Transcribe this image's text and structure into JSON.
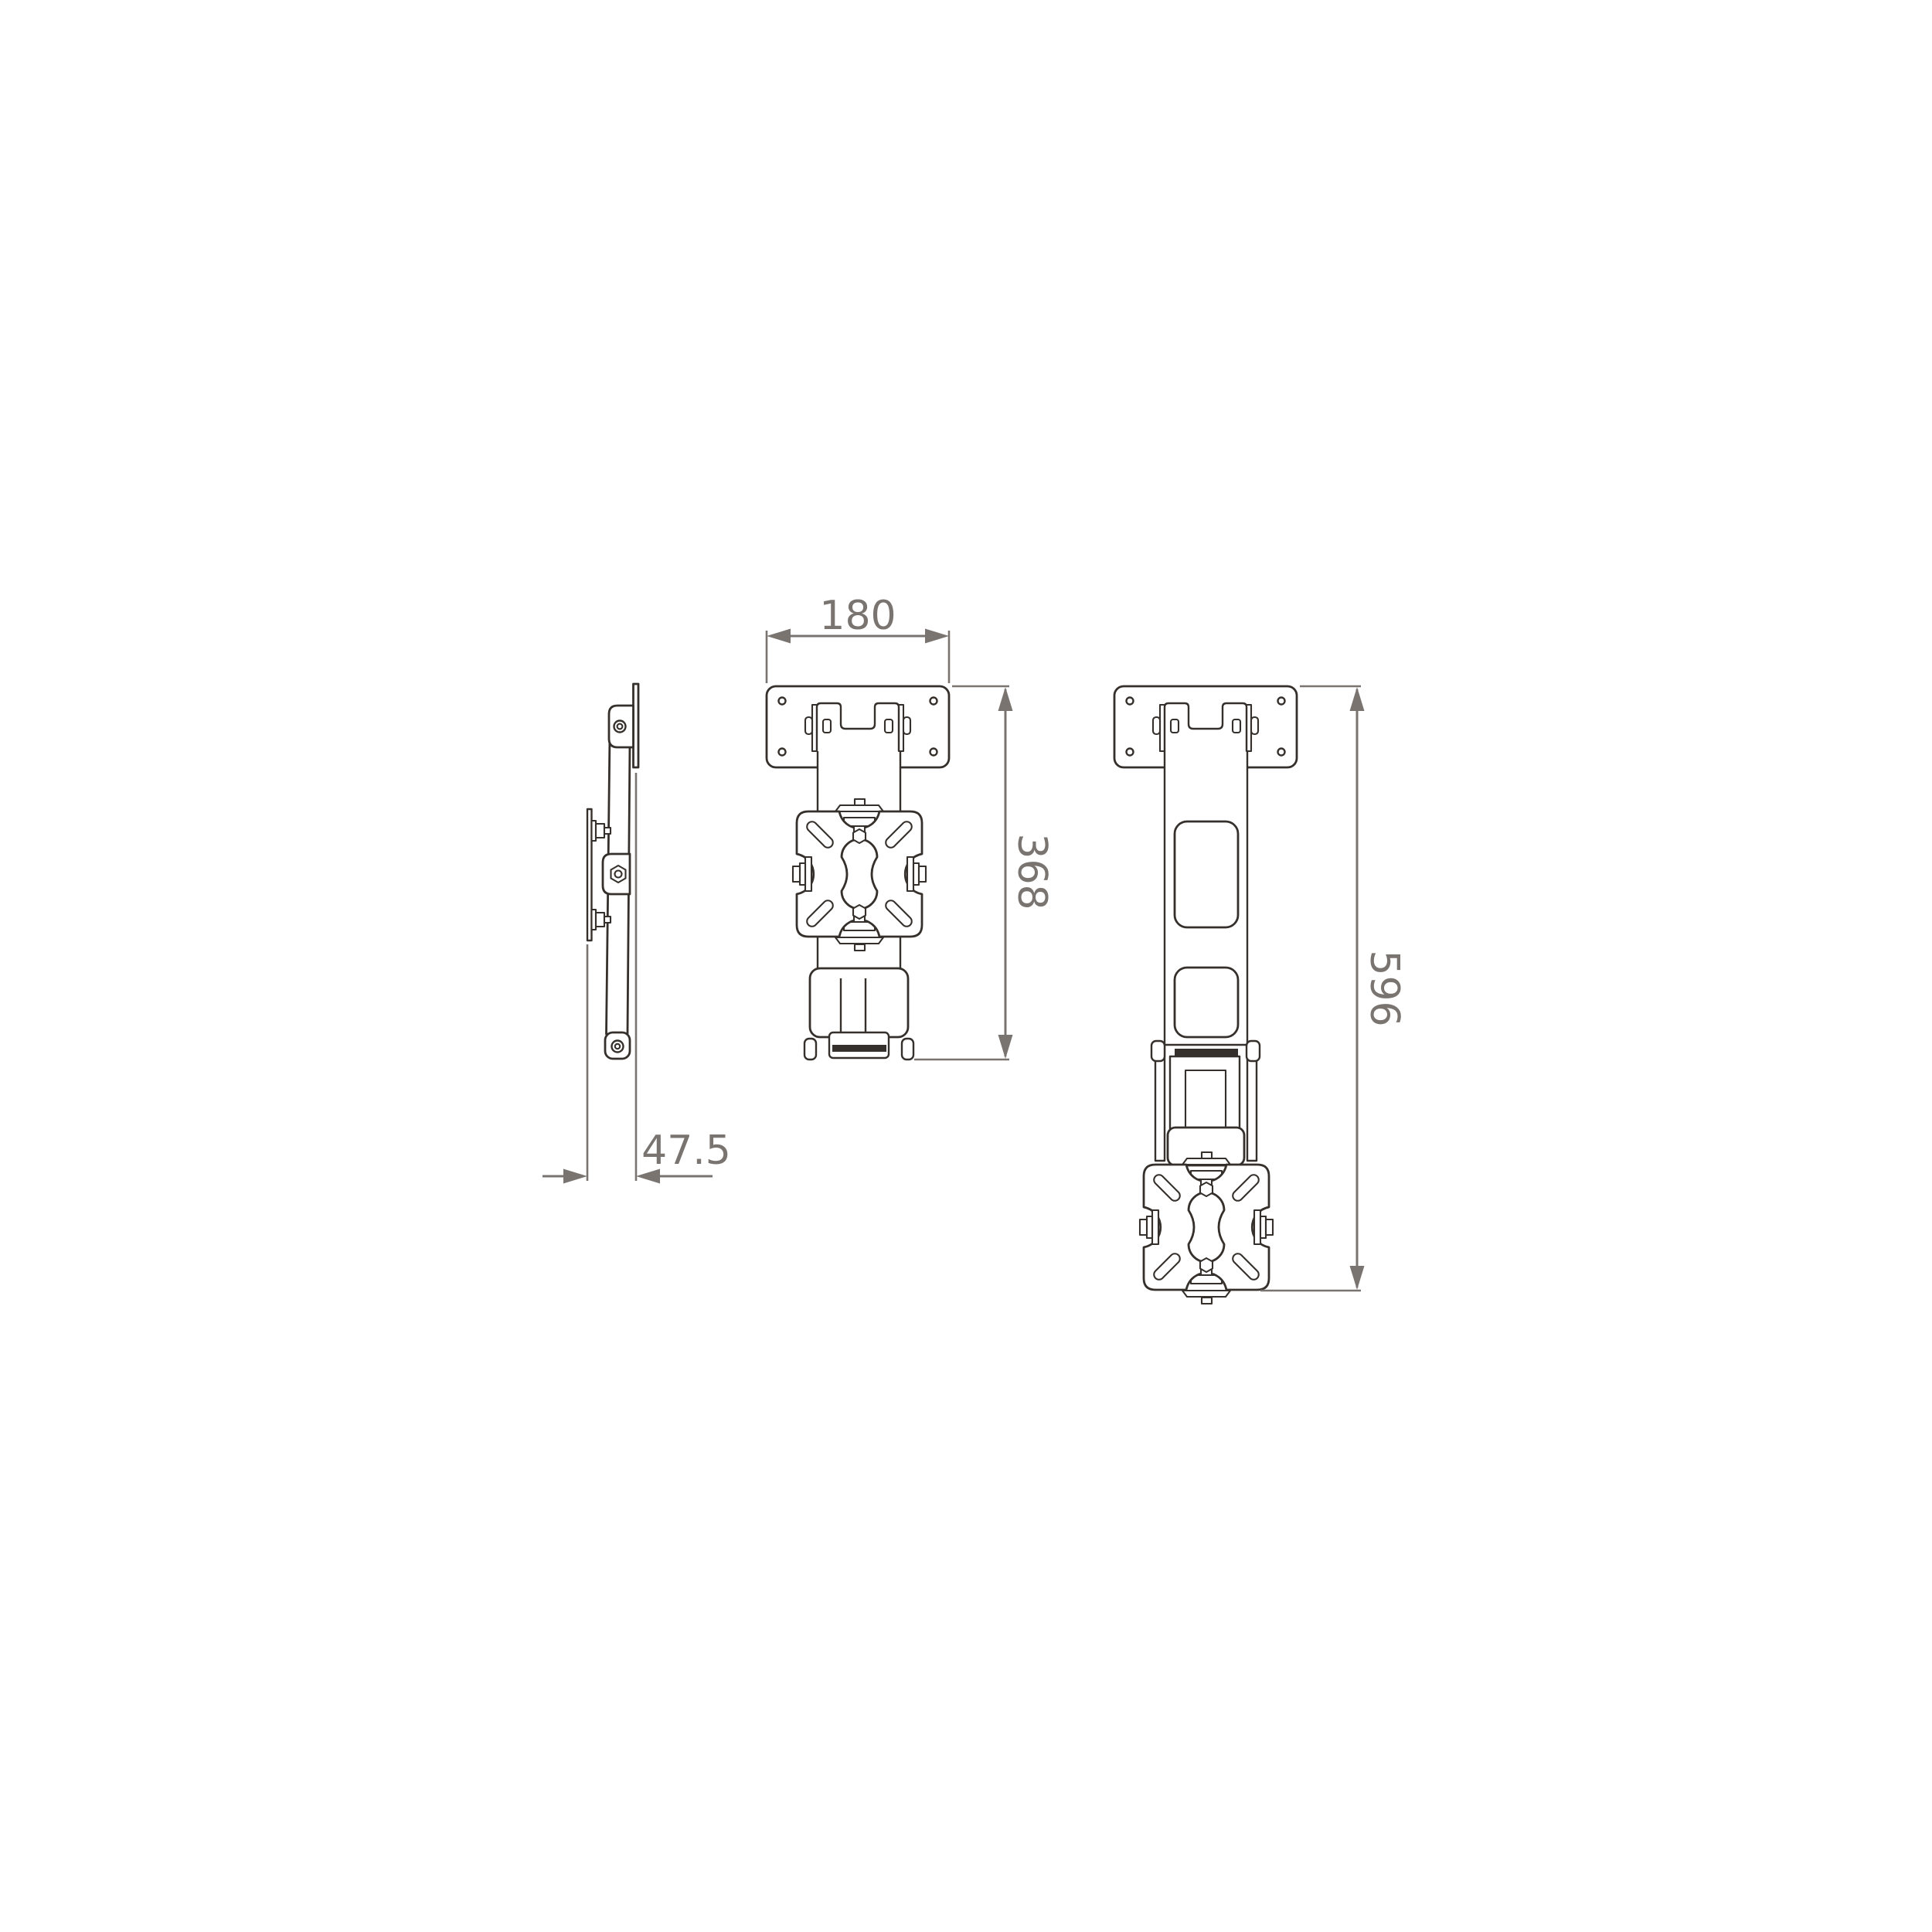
{
  "drawing": {
    "dimensions": {
      "plate_width": "180",
      "height_retracted": "368",
      "height_extended": "596",
      "depth": "47.5"
    },
    "colors": {
      "line": "#35302b",
      "dim": "#7a7470",
      "bg": "#ffffff"
    }
  }
}
